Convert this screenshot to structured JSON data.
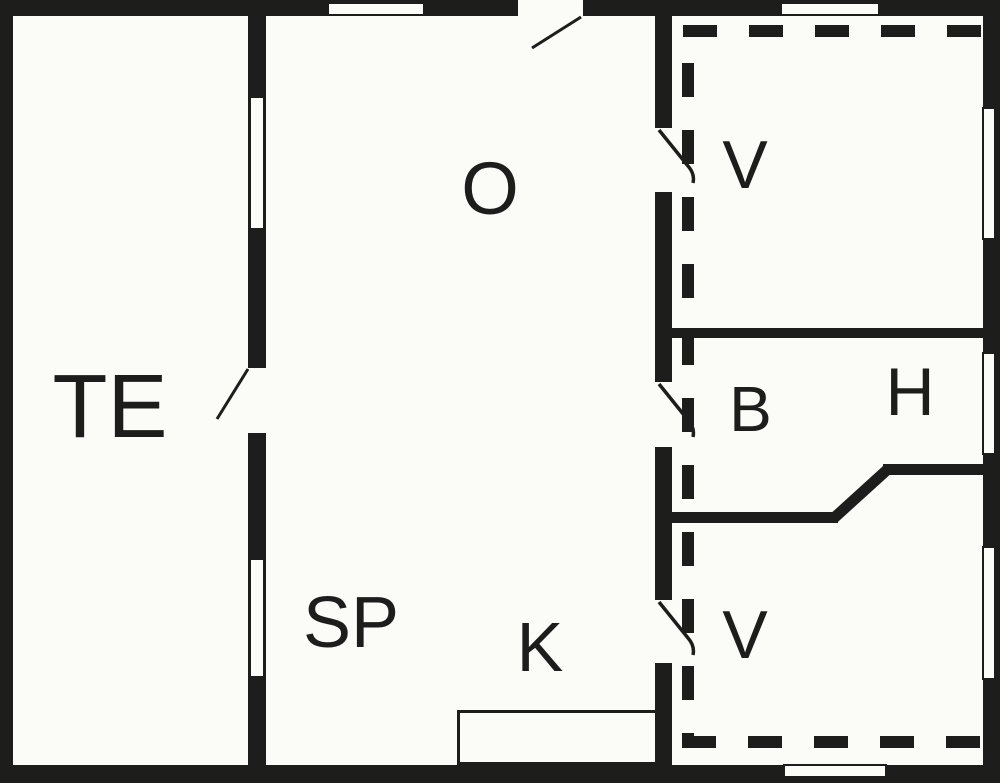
{
  "colors": {
    "wall": "#1d1d1b",
    "floor": "#fbfbf8"
  },
  "rooms": {
    "te": {
      "label": "TE"
    },
    "o": {
      "label": "O"
    },
    "sp": {
      "label": "SP"
    },
    "k": {
      "label": "K"
    },
    "v_top": {
      "label": "V"
    },
    "b": {
      "label": "B"
    },
    "h": {
      "label": "H"
    },
    "v_bottom": {
      "label": "V"
    }
  }
}
